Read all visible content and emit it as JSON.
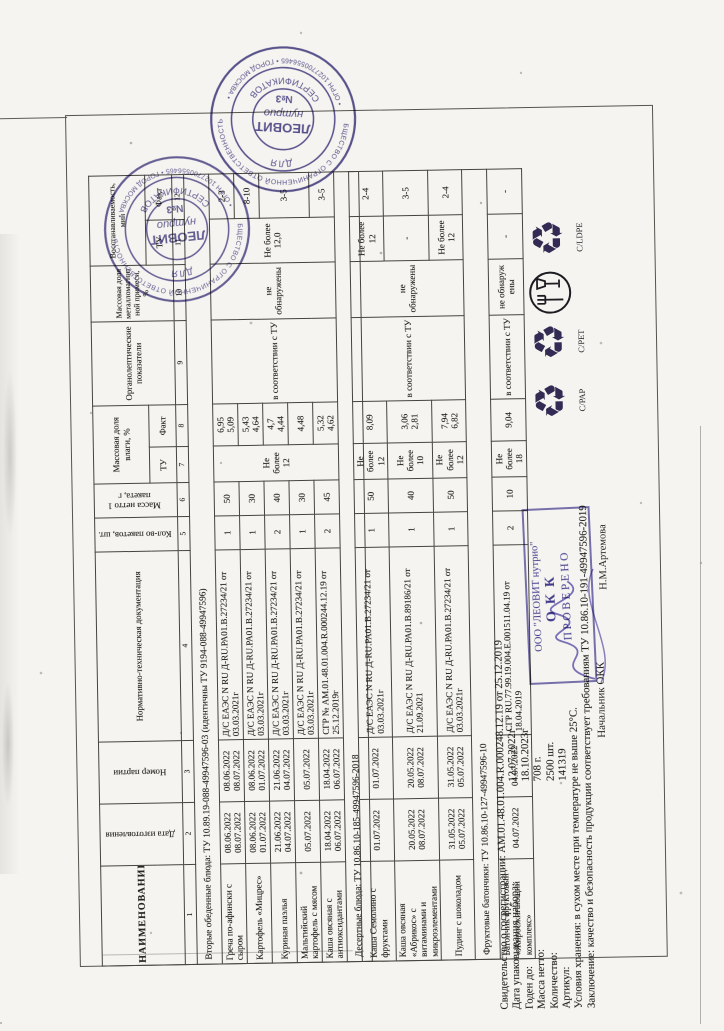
{
  "t1": {
    "h": {
      "c1": "НАИМЕНОВАНИЕ",
      "c2": "Дата изготовления",
      "c3": "Номер партии",
      "c4": "Нормативно-техническая документация",
      "c5": "Кол-во пакетов, шт.",
      "c6": "Масса нетто 1 пакета, г",
      "c7_8": "Массовая доля влаги, %",
      "c7": "ТУ",
      "c8": "Факт",
      "c9": "Органолептические показатели",
      "c10": "Массовая доля металломагнитной примеси, %",
      "c11_12": "Восстанавливаемость, мин",
      "c11": "ТУ",
      "c12": "Факт"
    },
    "nums": [
      "1",
      "2",
      "3",
      "4",
      "5",
      "6",
      "7",
      "8",
      "9",
      "10",
      "11",
      "12"
    ],
    "rows": [
      {
        "group": "Вторые обеденные блюда:  ТУ 10.89.19-088-49947596-03 (идентичны ТУ  9194-088-49947596)"
      },
      {
        "cells": [
          {
            "t": "Греча по-афински с сыром",
            "cls": "nm"
          },
          {
            "t": "08.06.2022\n08.07.2022"
          },
          {
            "t": "08.06.2022\n08.07.2022"
          },
          {
            "t": "Д/С ЕАЭС N RU Д-RU.РА01.В.27234/21 от 03.03.2021г",
            "cls": "lt"
          },
          {
            "t": "1"
          },
          {
            "t": "50"
          },
          {
            "t": "Не более 12",
            "rs": 5
          },
          {
            "t": "6,95\n5,09"
          },
          {
            "t": "в соответствии с ТУ",
            "rs": 5
          },
          {
            "t": "не обнаружены",
            "rs": 5
          },
          {
            "t": "Не более 12,0",
            "rs": 5
          },
          {
            "t": "2-3"
          }
        ]
      },
      {
        "cells": [
          {
            "t": "Картофель «Мицрес»",
            "cls": "nm"
          },
          {
            "t": "08.06.2022\n01.07.2022"
          },
          {
            "t": "08.06.2022\n01.07.2022"
          },
          {
            "t": "Д/С ЕАЭС N RU Д-RU.РА01.В.27234/21 от 03.03.2021г",
            "cls": "lt"
          },
          {
            "t": "1"
          },
          {
            "t": "30"
          },
          {
            "t": "5,43\n4,64"
          },
          {
            "t": "8-10"
          }
        ]
      },
      {
        "cells": [
          {
            "t": "Куриная паэлья",
            "cls": "nm"
          },
          {
            "t": "21.06.2022\n04.07.2022"
          },
          {
            "t": "21.06.2022\n04.07.2022"
          },
          {
            "t": "Д/С ЕАЭС N RU Д-RU.РА01.В.27234/21 от 03.03.2021г",
            "cls": "lt"
          },
          {
            "t": "2"
          },
          {
            "t": "40"
          },
          {
            "t": "4,7\n4,44"
          },
          {
            "t": "3-5",
            "rs": 2
          }
        ]
      },
      {
        "cells": [
          {
            "t": "Мальтийский картофель с мясом",
            "cls": "nm"
          },
          {
            "t": "05.07.2022"
          },
          {
            "t": "05.07.2022"
          },
          {
            "t": "Д/С ЕАЭС N RU Д-RU.РА01.В.27234/21 от 03.03.2021г",
            "cls": "lt"
          },
          {
            "t": "1"
          },
          {
            "t": "30"
          },
          {
            "t": "4,48"
          }
        ]
      },
      {
        "cells": [
          {
            "t": "Каша овсяная с антиоксидантами",
            "cls": "nm"
          },
          {
            "t": "18.04.2022\n06.07.2022"
          },
          {
            "t": "18.04.2022\n06.07.2022"
          },
          {
            "t": "СГР № АМ.01.48.01.004.R.000244.12.19 от 25.12.2019г",
            "cls": "lt"
          },
          {
            "t": "2"
          },
          {
            "t": "45"
          },
          {
            "t": "5,32\n4,62"
          },
          {
            "t": "3-5"
          }
        ]
      },
      {
        "group": "Десертные блюда:  ТУ 10.86.10-185-49947596-2018"
      }
    ]
  },
  "t2": {
    "rows": [
      {
        "cells": [
          {
            "t": "Каша Семолино с фруктами",
            "cls": "nm"
          },
          {
            "t": "01.07.2022"
          },
          {
            "t": "01.07.2022"
          },
          {
            "t": "Д/С ЕАЭС N RU Д-RU.РА01.В.27234/21 от 03.03.2021г",
            "cls": "lt"
          },
          {
            "t": "1"
          },
          {
            "t": "50"
          },
          {
            "t": "Не более 12"
          },
          {
            "t": "8,09"
          },
          {
            "t": "в соответствии с ТУ",
            "rs": 3
          },
          {
            "t": "не обнаружены",
            "rs": 3
          },
          {
            "t": "Не более 12"
          },
          {
            "t": "2-4"
          }
        ]
      },
      {
        "cells": [
          {
            "t": "Каша овсяная «Абрикос» с витаминами и микроэлементами",
            "cls": "nm"
          },
          {
            "t": "20.05.2022\n08.07.2022"
          },
          {
            "t": "20.05.2022\n08.07.2022"
          },
          {
            "t": "Д/С ЕАЭС N RU Д-RU.РА01.В.89186/21 от 21.09.2021",
            "cls": "lt"
          },
          {
            "t": "1"
          },
          {
            "t": "40"
          },
          {
            "t": "Не более 10"
          },
          {
            "t": "3,06\n2,81"
          },
          {
            "t": "-"
          },
          {
            "t": "3-5"
          }
        ]
      },
      {
        "cells": [
          {
            "t": "Пудинг с шоколадом",
            "cls": "nm"
          },
          {
            "t": "31.05.2022\n05.07.2022"
          },
          {
            "t": "31.05.2022\n05.07.2022"
          },
          {
            "t": "Д/С ЕАЭС N RU Д-RU.РА01.В.27234/21 от 03.03.2021г",
            "cls": "lt"
          },
          {
            "t": "1"
          },
          {
            "t": "50"
          },
          {
            "t": "Не более 12"
          },
          {
            "t": "7,94\n6,82"
          },
          {
            "t": "Не более 12"
          },
          {
            "t": "2-4"
          }
        ]
      },
      {
        "group": "Фруктовые батончики:  ТУ 10.86.10-127-49947596-10"
      },
      {
        "cells": [
          {
            "t": "Батончик фруктовый «Жиросжигающий комплекс»",
            "cls": "nm"
          },
          {
            "t": "04.07.2022"
          },
          {
            "t": "04.07.2022"
          },
          {
            "t": "СГР RU.77.99.19.004.Е.001511.04.19 от 18.04.2019",
            "cls": "lt"
          },
          {
            "t": "2"
          },
          {
            "t": "10"
          },
          {
            "t": "Не более 18"
          },
          {
            "t": "9,04"
          },
          {
            "t": "в соответствии с ТУ"
          },
          {
            "t": "не обнаруж ены"
          },
          {
            "t": "-"
          },
          {
            "t": "-"
          }
        ]
      }
    ]
  },
  "info": {
    "lines": [
      {
        "l": "Свидетельство о госрегистрации:",
        "v": "АМ.01.48.01.004.R.000248.12.19 от 25.12.2019"
      },
      {
        "l": "Дата упаковывания набора:",
        "v": "12.07.2022г",
        "cols": true
      },
      {
        "l": "Годен до:",
        "v": "18.10.2023г",
        "cols": true
      },
      {
        "l": "Масса нетто:",
        "v": "708 г.",
        "cols": true
      },
      {
        "l": "Количество:",
        "v": "2500 шт.",
        "cols": true
      },
      {
        "l": "Артикул:",
        "v": "141319",
        "cols": true
      },
      {
        "l": "Условия хранения:",
        "v": "в сухом месте при температуре не выше 25°С."
      },
      {
        "l": "Заключение:",
        "v": "качество и безопасность продукции соответствует требованиям ТУ 10.86.10-191-49947596-2019"
      }
    ],
    "signoff_label": "Начальник ОКК",
    "signoff_name": "Н.М.Артемова"
  },
  "box_stamp": {
    "line1": "ООО \"ЛЕОВИТ нутрио\"",
    "line2": "ОКК",
    "line3": "ПРОВЕРЕНО"
  },
  "round_stamp": {
    "outer_top": "ОБЩЕСТВО С ОГРАНИЧЕННОЙ ОТВЕТСТВЕННОСТЬЮ",
    "outer_bottom": "• ОГРН 1027700556465 • ГОРОД МОСКВА •",
    "ring_top": "ДЛЯ",
    "ring_bottom": "СЕРТИФИКАТОВ",
    "center1": "ЛЕОВИТ",
    "center2": "нутрио",
    "center3": "№3"
  },
  "recycling": {
    "label1": "С/РАР",
    "label2": "С/РЕТ",
    "label4": "C/LDPE",
    "symbol": "♻"
  },
  "ink": {
    "stamp": "#4a4382",
    "signature": "#5a4fa8"
  }
}
